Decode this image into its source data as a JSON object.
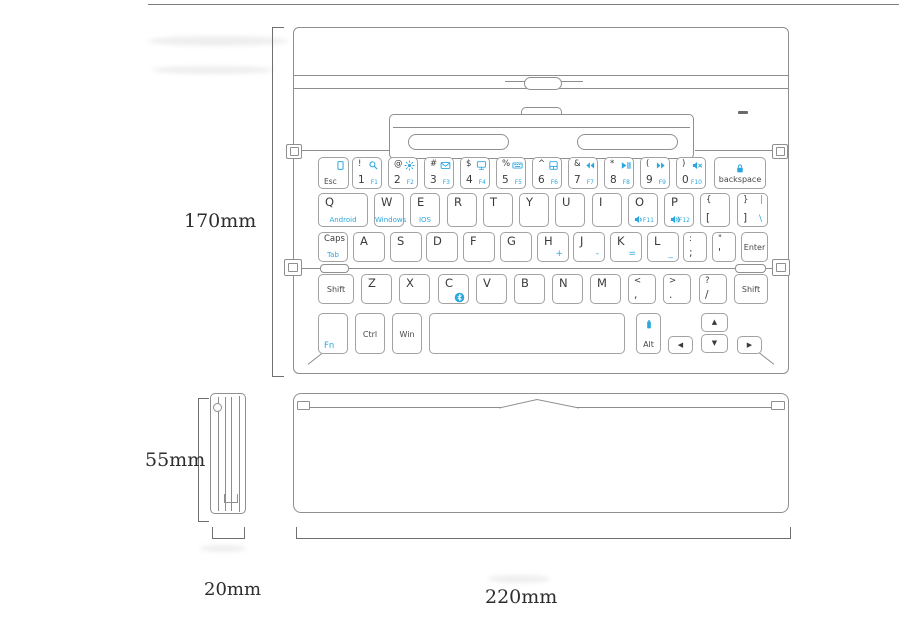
{
  "diagram": {
    "dimensions": {
      "open_height": "170mm",
      "folded_height": "55mm",
      "folded_depth": "20mm",
      "width": "220mm"
    }
  },
  "keyboard": {
    "rows": [
      [
        {
          "name": "key-esc",
          "label": "Esc",
          "labelPos": "bl",
          "icon": "screen-lock-icon",
          "iconPos": "tr"
        },
        {
          "name": "key-1",
          "tl": "!",
          "bl": "1",
          "br": "F1",
          "icon": "search-icon",
          "iconPos": "tr"
        },
        {
          "name": "key-2",
          "tl": "@",
          "bl": "2",
          "br": "F2",
          "icon": "brightness-icon",
          "iconPos": "tr"
        },
        {
          "name": "key-3",
          "tl": "#",
          "bl": "3",
          "br": "F3",
          "icon": "email-icon",
          "iconPos": "tr"
        },
        {
          "name": "key-4",
          "tl": "$",
          "bl": "4",
          "br": "F4",
          "icon": "monitor-icon",
          "iconPos": "tr"
        },
        {
          "name": "key-5",
          "tl": "%",
          "bl": "5",
          "br": "F5",
          "icon": "keyboard-light-icon",
          "iconPos": "tr"
        },
        {
          "name": "key-6",
          "tl": "^",
          "bl": "6",
          "br": "F6",
          "icon": "touchpad-icon",
          "iconPos": "tr"
        },
        {
          "name": "key-7",
          "tl": "&",
          "bl": "7",
          "br": "F7",
          "icon": "prev-track-icon",
          "iconPos": "tr"
        },
        {
          "name": "key-8",
          "tl": "*",
          "bl": "8",
          "br": "F8",
          "icon": "play-pause-icon",
          "iconPos": "tr"
        },
        {
          "name": "key-9",
          "tl": "(",
          "bl": "9",
          "br": "F9",
          "icon": "next-track-icon",
          "iconPos": "tr"
        },
        {
          "name": "key-0",
          "tl": ")",
          "bl": "0",
          "br": "F10",
          "icon": "mute-icon",
          "iconPos": "tr"
        },
        {
          "name": "key-backspace",
          "label": "backspace",
          "icon": "lock-icon",
          "iconPos": "t"
        }
      ],
      [
        {
          "name": "key-q",
          "letter": "Q",
          "sub": "Android"
        },
        {
          "name": "key-w",
          "letter": "W",
          "sub": "Windows"
        },
        {
          "name": "key-e",
          "letter": "E",
          "sub": "IOS"
        },
        {
          "name": "key-r",
          "letter": "R"
        },
        {
          "name": "key-t",
          "letter": "T"
        },
        {
          "name": "key-y",
          "letter": "Y"
        },
        {
          "name": "key-u",
          "letter": "U"
        },
        {
          "name": "key-i",
          "letter": "I"
        },
        {
          "name": "key-o",
          "letter": "O",
          "br": "F11",
          "icon": "volume-down-icon",
          "iconPos": "bl"
        },
        {
          "name": "key-p",
          "letter": "P",
          "br": "F12",
          "icon": "volume-up-icon",
          "iconPos": "bl"
        },
        {
          "name": "key-left-bracket",
          "tl": "{",
          "bl": "["
        },
        {
          "name": "key-right-bracket",
          "tl": "}",
          "bl": "]",
          "tr": "|",
          "br": "\\",
          "bigBlue": true
        }
      ],
      [
        {
          "name": "key-caps-tab",
          "tl": "Caps",
          "sub": "Tab"
        },
        {
          "name": "key-a",
          "letter": "A"
        },
        {
          "name": "key-s",
          "letter": "S"
        },
        {
          "name": "key-d",
          "letter": "D"
        },
        {
          "name": "key-f",
          "letter": "F"
        },
        {
          "name": "key-g",
          "letter": "G"
        },
        {
          "name": "key-h",
          "letter": "H",
          "br": "+",
          "bigBlue": true
        },
        {
          "name": "key-j",
          "letter": "J",
          "br": "-",
          "bigBlue": true
        },
        {
          "name": "key-k",
          "letter": "K",
          "br": "=",
          "bigBlue": true
        },
        {
          "name": "key-l",
          "letter": "L",
          "br": "_",
          "bigBlue": true
        },
        {
          "name": "key-semicolon",
          "tl": ":",
          "bl": ";"
        },
        {
          "name": "key-quote",
          "tl": "\"",
          "bl": "'"
        },
        {
          "name": "key-enter",
          "label": "Enter"
        }
      ],
      [
        {
          "name": "key-shift-left",
          "label": "Shift"
        },
        {
          "name": "key-z",
          "letter": "Z"
        },
        {
          "name": "key-x",
          "letter": "X"
        },
        {
          "name": "key-c",
          "letter": "C",
          "icon": "bluetooth-icon",
          "iconPos": "br"
        },
        {
          "name": "key-v",
          "letter": "V"
        },
        {
          "name": "key-b",
          "letter": "B"
        },
        {
          "name": "key-n",
          "letter": "N"
        },
        {
          "name": "key-m",
          "letter": "M"
        },
        {
          "name": "key-comma",
          "tl": "<",
          "bl": ","
        },
        {
          "name": "key-period",
          "tl": ">",
          "bl": "."
        },
        {
          "name": "key-slash",
          "tl": "?",
          "bl": "/"
        },
        {
          "name": "key-shift-right",
          "label": "Shift"
        }
      ],
      [
        {
          "name": "key-fn",
          "label": "Fn",
          "labelPos": "bl",
          "blue": true
        },
        {
          "name": "key-ctrl",
          "label": "Ctrl"
        },
        {
          "name": "key-win",
          "label": "Win"
        },
        {
          "name": "key-space",
          "label": ""
        },
        {
          "name": "key-alt",
          "label": "Alt",
          "icon": "battery-icon",
          "iconPos": "t"
        },
        {
          "name": "key-arrow-left",
          "arrow": "left"
        },
        {
          "name": "key-arrow-up",
          "arrow": "up"
        },
        {
          "name": "key-arrow-down",
          "arrow": "down"
        },
        {
          "name": "key-arrow-right",
          "arrow": "right"
        }
      ]
    ]
  }
}
